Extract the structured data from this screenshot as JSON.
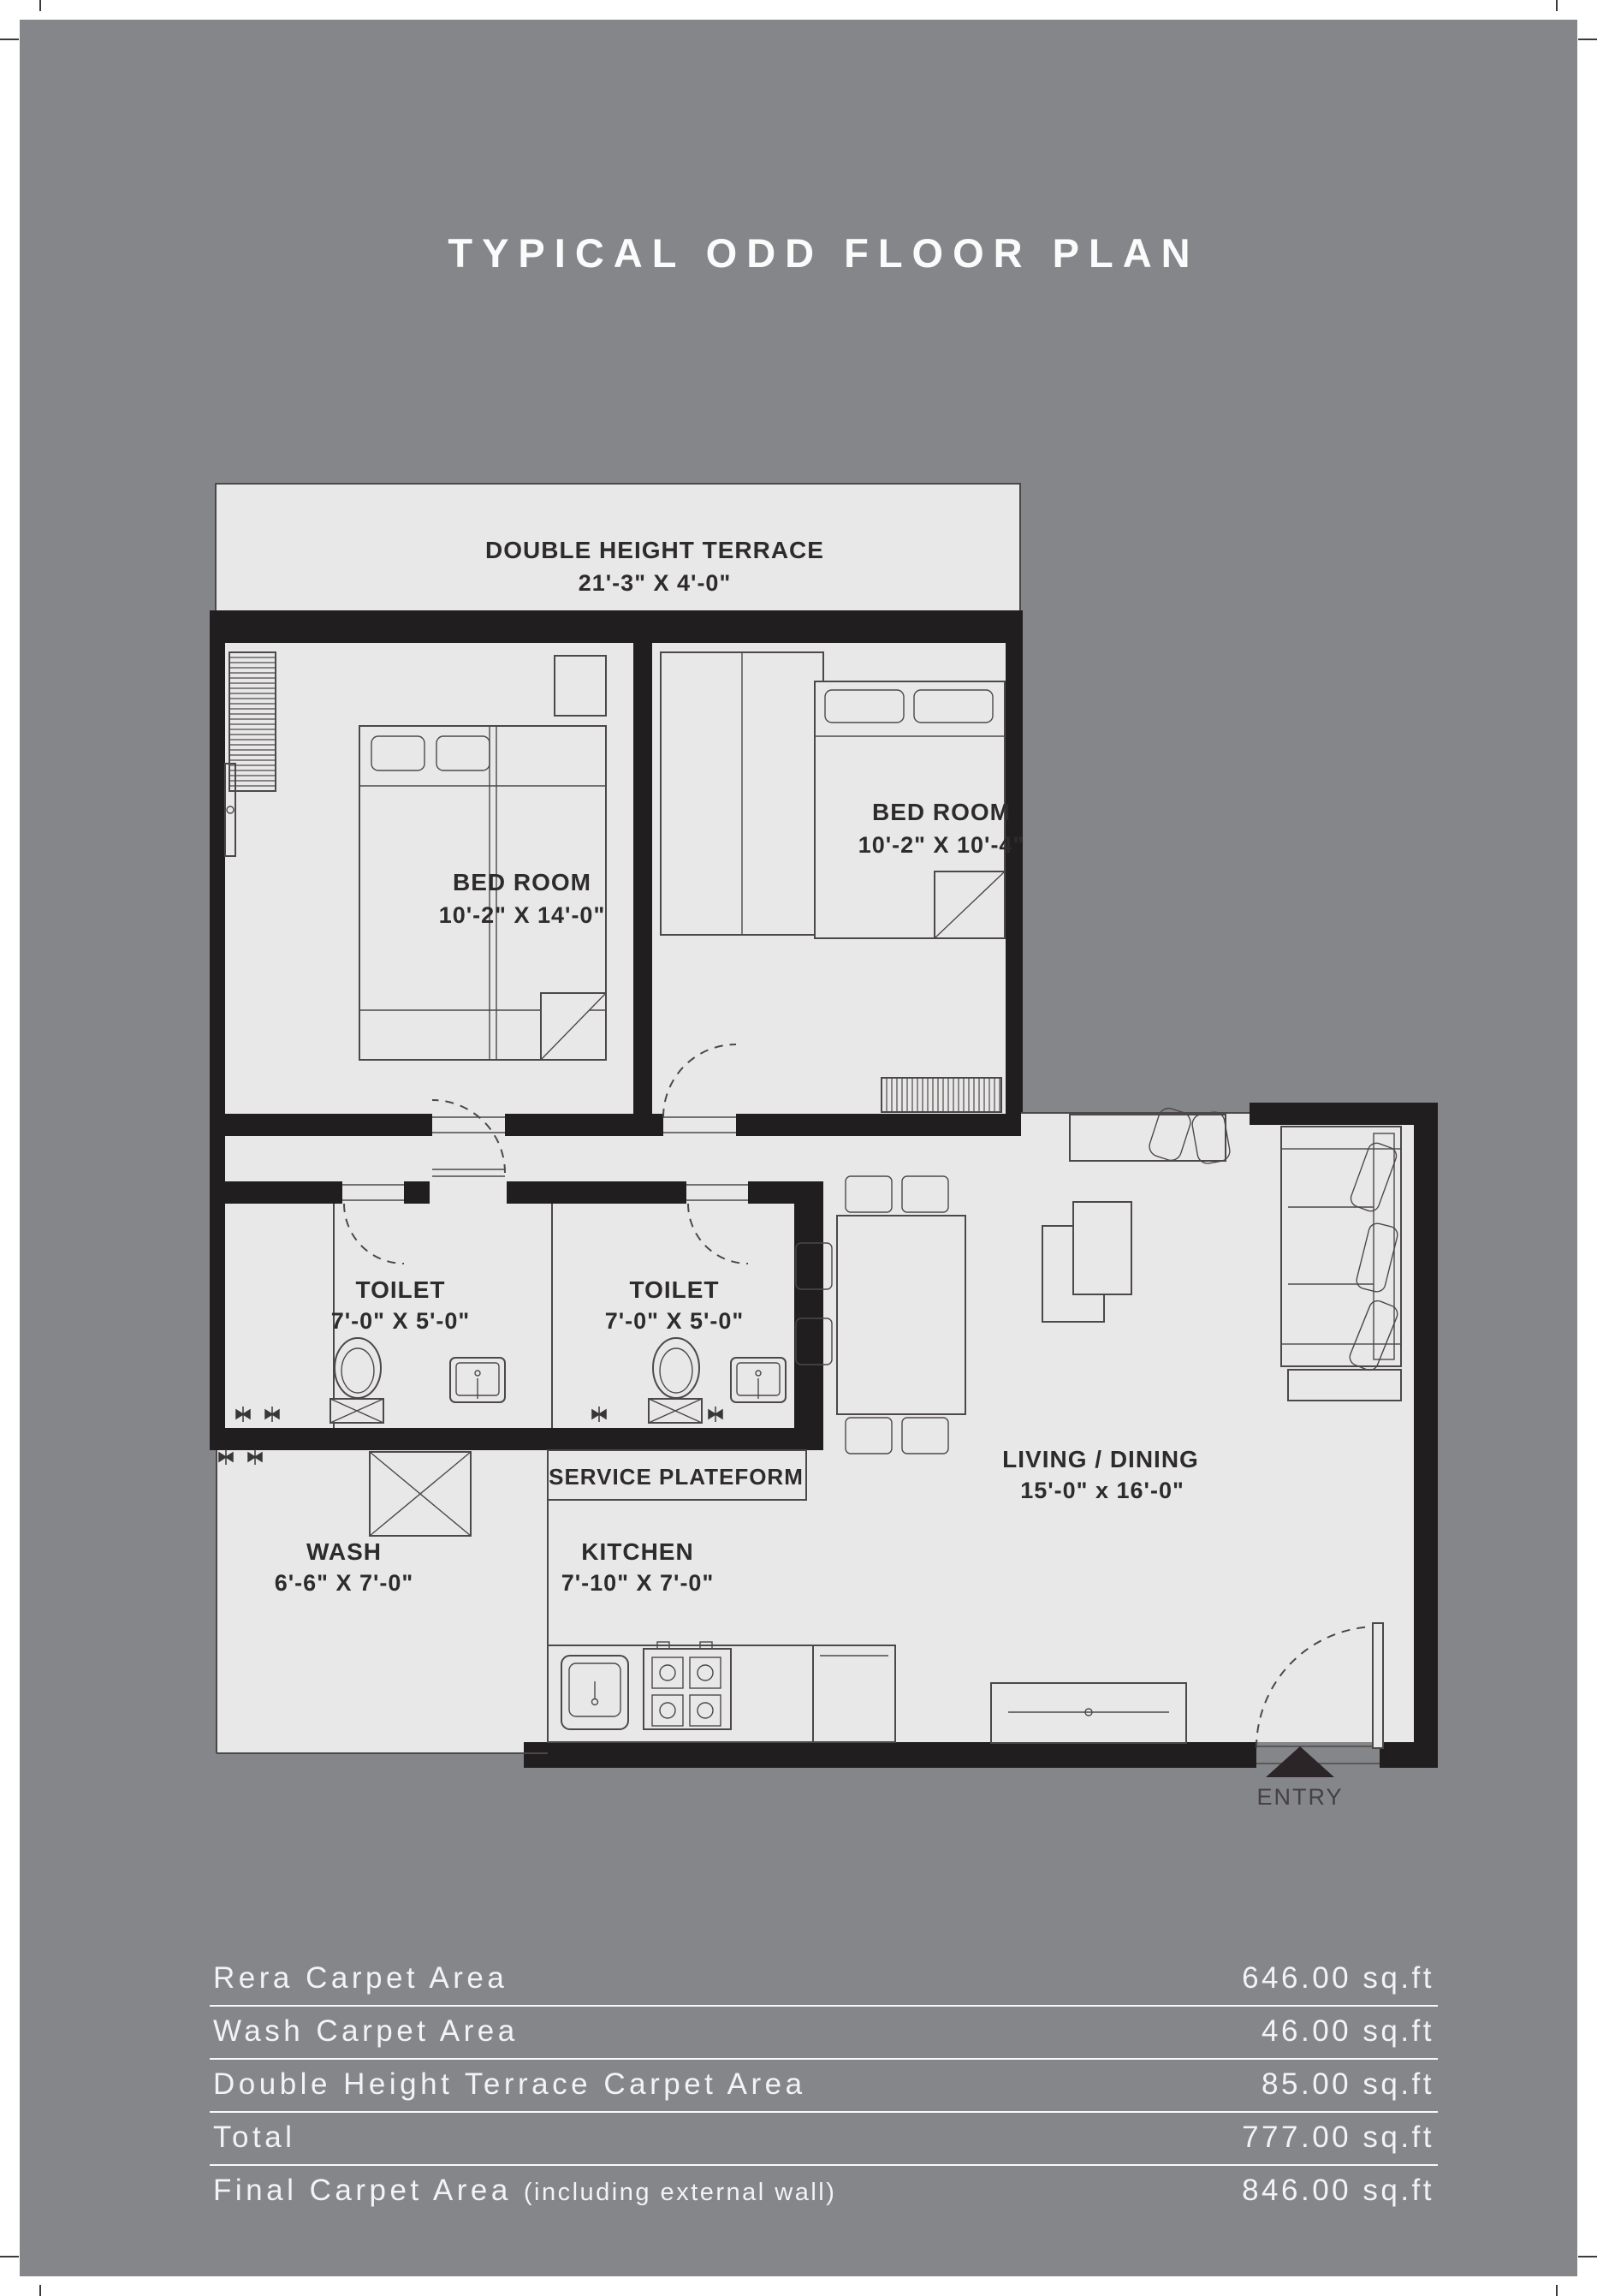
{
  "title": "TYPICAL ODD FLOOR PLAN",
  "colors": {
    "page_bg": "#84868a",
    "floor": "#e9e8e8",
    "wall": "#211e20",
    "line": "#4c4848",
    "plan_text": "#2d2b2c",
    "light_text": "#f3f3f5"
  },
  "rooms": {
    "terrace": {
      "label": "DOUBLE HEIGHT TERRACE",
      "dims": "21'-3\" X 4'-0\""
    },
    "bedroom_left": {
      "label": "BED ROOM",
      "dims": "10'-2\" X 14'-0\""
    },
    "bedroom_right": {
      "label": "BED ROOM",
      "dims": "10'-2\" X 10'-4\""
    },
    "toilet_left": {
      "label": "TOILET",
      "dims": "7'-0\" X 5'-0\""
    },
    "toilet_right": {
      "label": "TOILET",
      "dims": "7'-0\" X 5'-0\""
    },
    "service_platform": {
      "label": "SERVICE PLATEFORM"
    },
    "wash": {
      "label": "WASH",
      "dims": "6'-6\" X 7'-0\""
    },
    "kitchen": {
      "label": "KITCHEN",
      "dims": "7'-10\" X 7'-0\""
    },
    "living_dining": {
      "label": "LIVING / DINING",
      "dims": "15'-0\" x 16'-0\""
    }
  },
  "entry": {
    "label": "ENTRY"
  },
  "area_table": {
    "rows": [
      {
        "label": "Rera Carpet Area",
        "note": "",
        "value": "646.00 sq.ft"
      },
      {
        "label": "Wash Carpet Area",
        "note": "",
        "value": "46.00 sq.ft"
      },
      {
        "label": "Double Height Terrace Carpet Area",
        "note": "",
        "value": "85.00 sq.ft"
      },
      {
        "label": "Total",
        "note": "",
        "value": "777.00 sq.ft"
      },
      {
        "label": "Final Carpet Area",
        "note": "(including external wall)",
        "value": "846.00 sq.ft"
      }
    ]
  }
}
